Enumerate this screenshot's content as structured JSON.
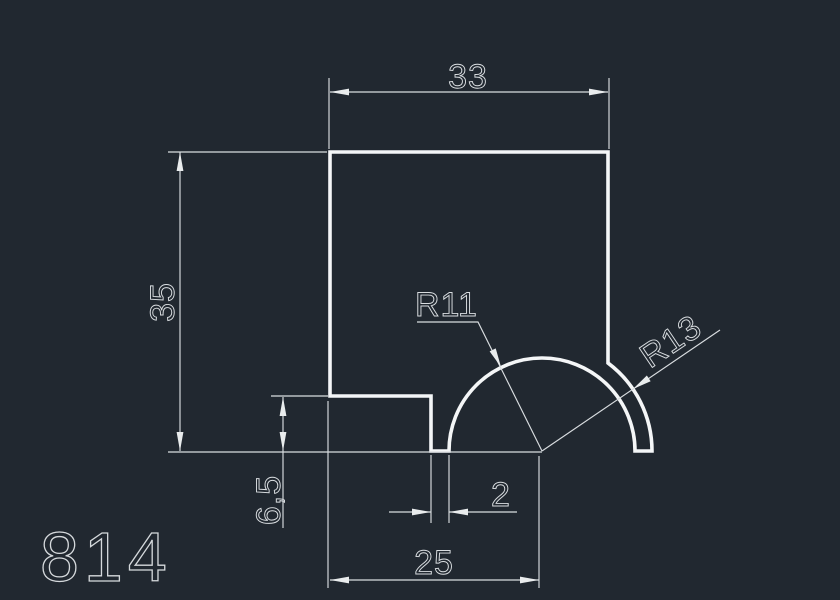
{
  "drawing": {
    "part_number": "814",
    "dimensions": {
      "top_width": "33",
      "left_height": "35",
      "inner_radius": "R11",
      "outer_radius": "R13",
      "step_height": "6,5",
      "slot_width": "2",
      "bottom_width": "25"
    },
    "colors": {
      "background": "#212830",
      "profile_line": "#f4f6f7",
      "dimension_line": "#d9dde0",
      "arrow_fill": "#e9eced"
    }
  }
}
